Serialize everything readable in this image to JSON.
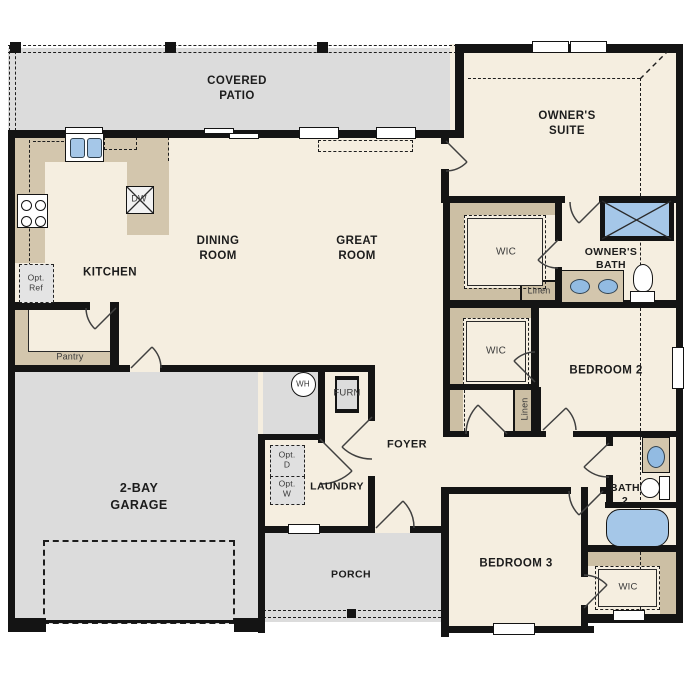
{
  "rooms": {
    "covered_patio": {
      "label": "COVERED",
      "label2": "PATIO"
    },
    "owners_suite": {
      "label": "OWNER'S",
      "label2": "SUITE"
    },
    "kitchen": {
      "label": "KITCHEN"
    },
    "dining_room": {
      "label": "DINING",
      "label2": "ROOM"
    },
    "great_room": {
      "label": "GREAT",
      "label2": "ROOM"
    },
    "owners_bath": {
      "label": "OWNER'S",
      "label2": "BATH"
    },
    "owners_wic": {
      "label": "WIC"
    },
    "owners_linen": {
      "label": "Linen"
    },
    "hall_wic": {
      "label": "WIC"
    },
    "hall_linen": {
      "label": "Linen"
    },
    "bedroom_2": {
      "label": "BEDROOM 2"
    },
    "bath_2": {
      "label": "BATH",
      "label2": "2"
    },
    "bedroom_3": {
      "label": "BEDROOM 3"
    },
    "bedroom3_wic": {
      "label": "WIC"
    },
    "garage": {
      "label": "2-BAY",
      "label2": "GARAGE"
    },
    "laundry": {
      "label": "LAUNDRY"
    },
    "foyer": {
      "label": "FOYER"
    },
    "porch": {
      "label": "PORCH"
    },
    "pantry": {
      "label": "Pantry"
    }
  },
  "fixtures": {
    "water_heater": {
      "label": "WH"
    },
    "furnace": {
      "label": "FURN"
    },
    "dishwasher": {
      "label": "DW"
    },
    "opt_refrigerator": {
      "label": "Opt.",
      "label2": "Ref"
    },
    "opt_dryer": {
      "label": "Opt.",
      "label2": "D"
    },
    "opt_washer": {
      "label": "Opt.",
      "label2": "W"
    }
  },
  "colors": {
    "floor": "#f5eee0",
    "outdoor_concrete": "#dcdcdc",
    "cabinet_tan": "#d3c6ad",
    "closet_tan": "#ccbfa4",
    "plumbing_blue": "#a5c7e8",
    "wall_black": "#141414",
    "appliance_gray": "#e2e2e2"
  }
}
